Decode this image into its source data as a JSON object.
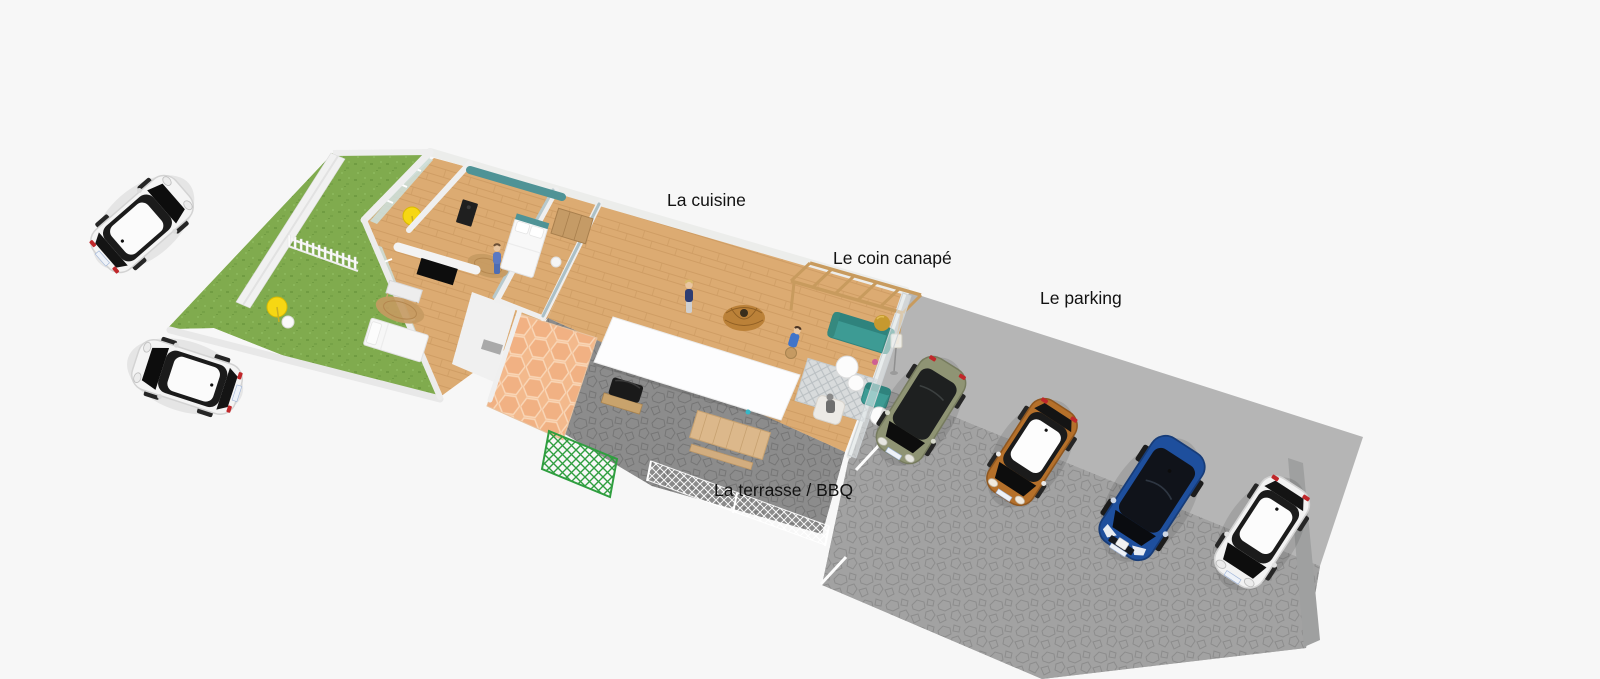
{
  "viewport": {
    "type": "3d-floorplan-render",
    "background": "#f7f7f7",
    "labels": {
      "kitchen": "La cuisine",
      "sofa_corner": "Le coin canapé",
      "parking": "Le parking",
      "terrace_bbq": "La terrasse / BBQ"
    },
    "areas": [
      "garden",
      "patio-room",
      "bedroom",
      "office-bedroom",
      "bathroom",
      "kitchen",
      "dining-bar",
      "sofa-corner",
      "terrace-bbq",
      "parking"
    ],
    "colors": {
      "grass": "#80ab4e",
      "wood_floor": "#dcab72",
      "counter_wood": "#d3a267",
      "terrace_paving": "#8c8c8c",
      "parking_paving": "#a2a2a2",
      "concrete_apron": "#b5b5b5",
      "accent_teal": "#3d9b94",
      "wall_white": "#ededeb",
      "wall_sage": "#c4d8c4",
      "wall_slate": "#acc0c6",
      "hex_tile": "#f3b98c",
      "pergola_wood": "#c89b5e",
      "trellis_green": "#2f9e3f",
      "parasol_yellow": "#f6d713",
      "label_text": "#121212"
    },
    "cars": {
      "street": [
        {
          "name": "white-mini-upper",
          "color": "#f4f4f4",
          "roof": "#fbfbfb"
        },
        {
          "name": "white-mini-lower",
          "color": "#f4f4f4",
          "roof": "#fbfbfb"
        }
      ],
      "parked": [
        {
          "name": "olive-car",
          "color": "#8f9474",
          "roof": "#1e2020"
        },
        {
          "name": "orange-mini",
          "color": "#b5702a",
          "roof": "#fdfdfd"
        },
        {
          "name": "blue-suv",
          "color": "#1e4f9d",
          "roof": "#10131a"
        },
        {
          "name": "white-mini",
          "color": "#f2f2f2",
          "roof": "#fcfcfc"
        }
      ]
    }
  }
}
